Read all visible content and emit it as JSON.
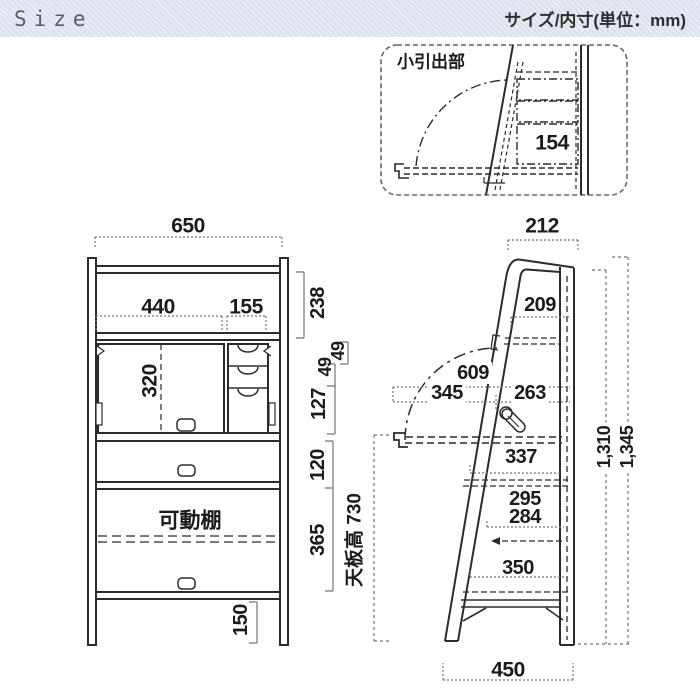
{
  "header": {
    "title": "Size",
    "subtitle": "サイズ/内寸(単位：mm)"
  },
  "callout": {
    "label": "小引出部",
    "drawer_inner_width": "154"
  },
  "front_view": {
    "overall_width": "650",
    "left_inner_width": "440",
    "drawer_inner_width": "155",
    "door_opening_height": "320",
    "top_open_height": "238",
    "small_drawer_height_1": "49",
    "small_drawer_height_2": "49",
    "lower_drawer_height": "127",
    "drawer_row_height": "120",
    "open_shelf_height": "365",
    "leg_height": "150",
    "movable_shelf_label": "可動棚"
  },
  "side_view": {
    "top_depth": "212",
    "upper_inner_depth": "209",
    "extended_depth": "609",
    "flap_depth": "345",
    "inner_depth_upper": "263",
    "desk_inner_depth": "337",
    "inner_depth_middle": "295",
    "inner_depth_lower": "284",
    "bottom_inner_depth": "350",
    "base_depth": "450",
    "height_back_post": "1,310",
    "overall_height": "1,345",
    "desk_height_label": "天板高 730"
  },
  "colors": {
    "line": "#2b2b2b",
    "dim_line": "#757575",
    "header_bg": "#dce3ed",
    "text": "#1b1b1b"
  }
}
